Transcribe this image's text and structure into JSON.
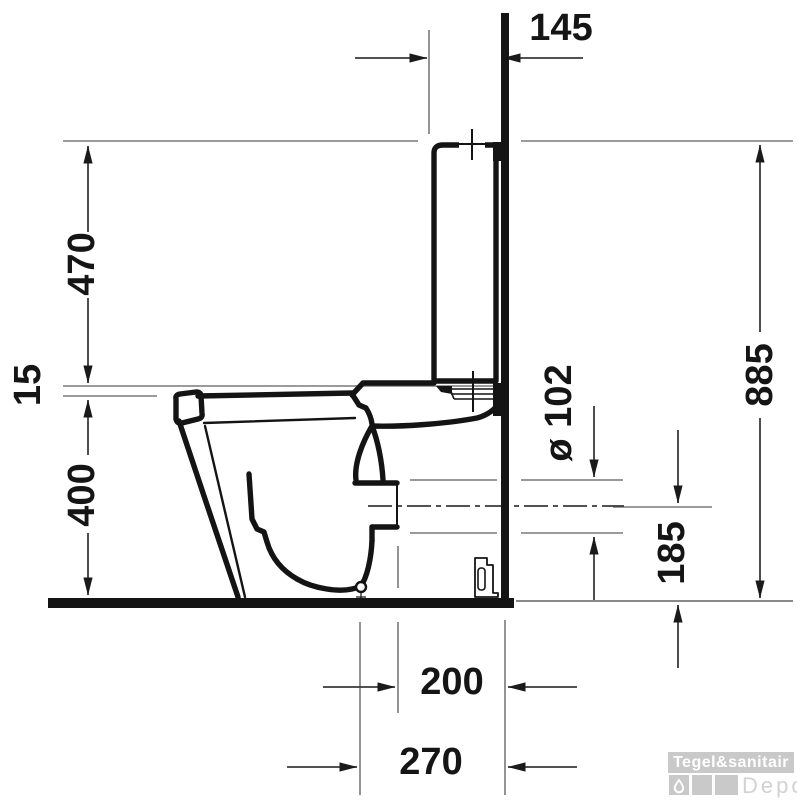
{
  "dimensions": {
    "cistern_depth": "145",
    "cistern_height": "470",
    "seat_gap": "15",
    "bowl_height": "400",
    "total_height": "885",
    "outlet_diameter": "ø 102",
    "outlet_center_height": "185",
    "outlet_face_offset": "200",
    "outlet_center_offset": "270"
  },
  "watermark": {
    "brand": "Tegel&sanitair",
    "label": "Depot"
  },
  "colors": {
    "outline": "#141414",
    "dimension_lines": "#3a3a3a",
    "extension_lines": "#7a7a7a",
    "watermark_gray": "#c9c9c9"
  }
}
